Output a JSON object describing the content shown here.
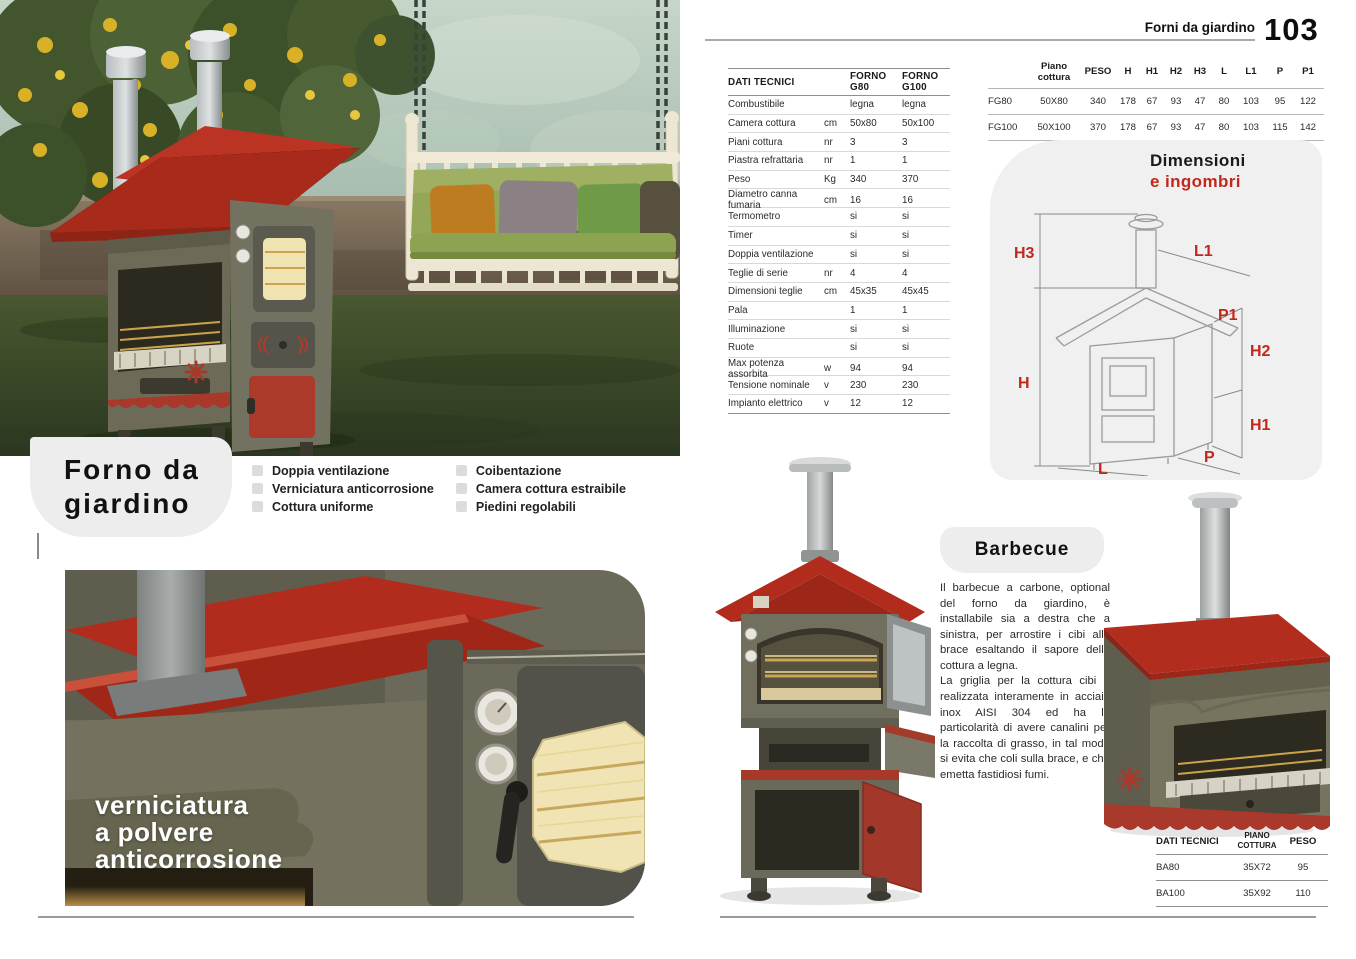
{
  "header": {
    "section": "Forni da giardino",
    "page_number": "103"
  },
  "intro": {
    "title_line1": "Forno da",
    "title_line2": "giardino",
    "features_col1": [
      "Doppia ventilazione",
      "Verniciatura anticorrosione",
      "Cottura uniforme"
    ],
    "features_col2": [
      "Coibentazione",
      "Camera cottura estraibile",
      "Piedini regolabili"
    ]
  },
  "closeup_caption": {
    "line1": "verniciatura",
    "line2": "a polvere",
    "line3": "anticorrosione"
  },
  "specs_table": {
    "headers": [
      "DATI TECNICI",
      "",
      "FORNO G80",
      "FORNO G100"
    ],
    "rows": [
      [
        "Combustibile",
        "",
        "legna",
        "legna"
      ],
      [
        "Camera cottura",
        "cm",
        "50x80",
        "50x100"
      ],
      [
        "Piani cottura",
        "nr",
        "3",
        "3"
      ],
      [
        "Piastra refrattaria",
        "nr",
        "1",
        "1"
      ],
      [
        "Peso",
        "Kg",
        "340",
        "370"
      ],
      [
        "Diametro canna fumaria",
        "cm",
        "16",
        "16"
      ],
      [
        "Termometro",
        "",
        "si",
        "si"
      ],
      [
        "Timer",
        "",
        "si",
        "si"
      ],
      [
        "Doppia ventilazione",
        "",
        "si",
        "si"
      ],
      [
        "Teglie di serie",
        "nr",
        "4",
        "4"
      ],
      [
        "Dimensioni teglie",
        "cm",
        "45x35",
        "45x45"
      ],
      [
        "Pala",
        "",
        "1",
        "1"
      ],
      [
        "Illuminazione",
        "",
        "si",
        "si"
      ],
      [
        "Ruote",
        "",
        "si",
        "si"
      ],
      [
        "Max potenza assorbita",
        "w",
        "94",
        "94"
      ],
      [
        "Tensione nominale",
        "v",
        "230",
        "230"
      ],
      [
        "Impianto elettrico",
        "v",
        "12",
        "12"
      ]
    ]
  },
  "dims_table": {
    "headers": [
      "",
      "Piano cottura",
      "PESO",
      "H",
      "H1",
      "H2",
      "H3",
      "L",
      "L1",
      "P",
      "P1"
    ],
    "rows": [
      [
        "FG80",
        "50X80",
        "340",
        "178",
        "67",
        "93",
        "47",
        "80",
        "103",
        "95",
        "122"
      ],
      [
        "FG100",
        "50X100",
        "370",
        "178",
        "67",
        "93",
        "47",
        "80",
        "103",
        "115",
        "142"
      ]
    ]
  },
  "dimensioni_heading": {
    "black": "Dimensioni",
    "red": "e ingombri"
  },
  "diagram_labels": {
    "h3": "H3",
    "h": "H",
    "h1": "H1",
    "h2": "H2",
    "l1": "L1",
    "p1": "P1",
    "p": "P",
    "l": "L"
  },
  "barbecue": {
    "title": "Barbecue",
    "para1": "Il barbecue a carbone, optional del forno da giardino, è installabile sia a destra che a sinistra, per arrostire i cibi alla brace esaltando il sapore della cottura a legna.",
    "para2": "La griglia per la cottura cibi è realizzata interamente in acciaio inox AISI 304 ed ha la particolarità di avere canalini per la raccolta di grasso, in tal modo si evita che coli sulla brace, e che emetta fastidiosi fumi.",
    "table": {
      "headers": [
        "DATI TECNICI",
        "PIANO COTTURA",
        "PESO"
      ],
      "rows": [
        [
          "BA80",
          "35X72",
          "95"
        ],
        [
          "BA100",
          "35X92",
          "110"
        ]
      ]
    }
  },
  "colors": {
    "accent_red": "#b5291c",
    "body_olive": "#6e6c5b",
    "panel_gray": "#f0f0f0"
  }
}
